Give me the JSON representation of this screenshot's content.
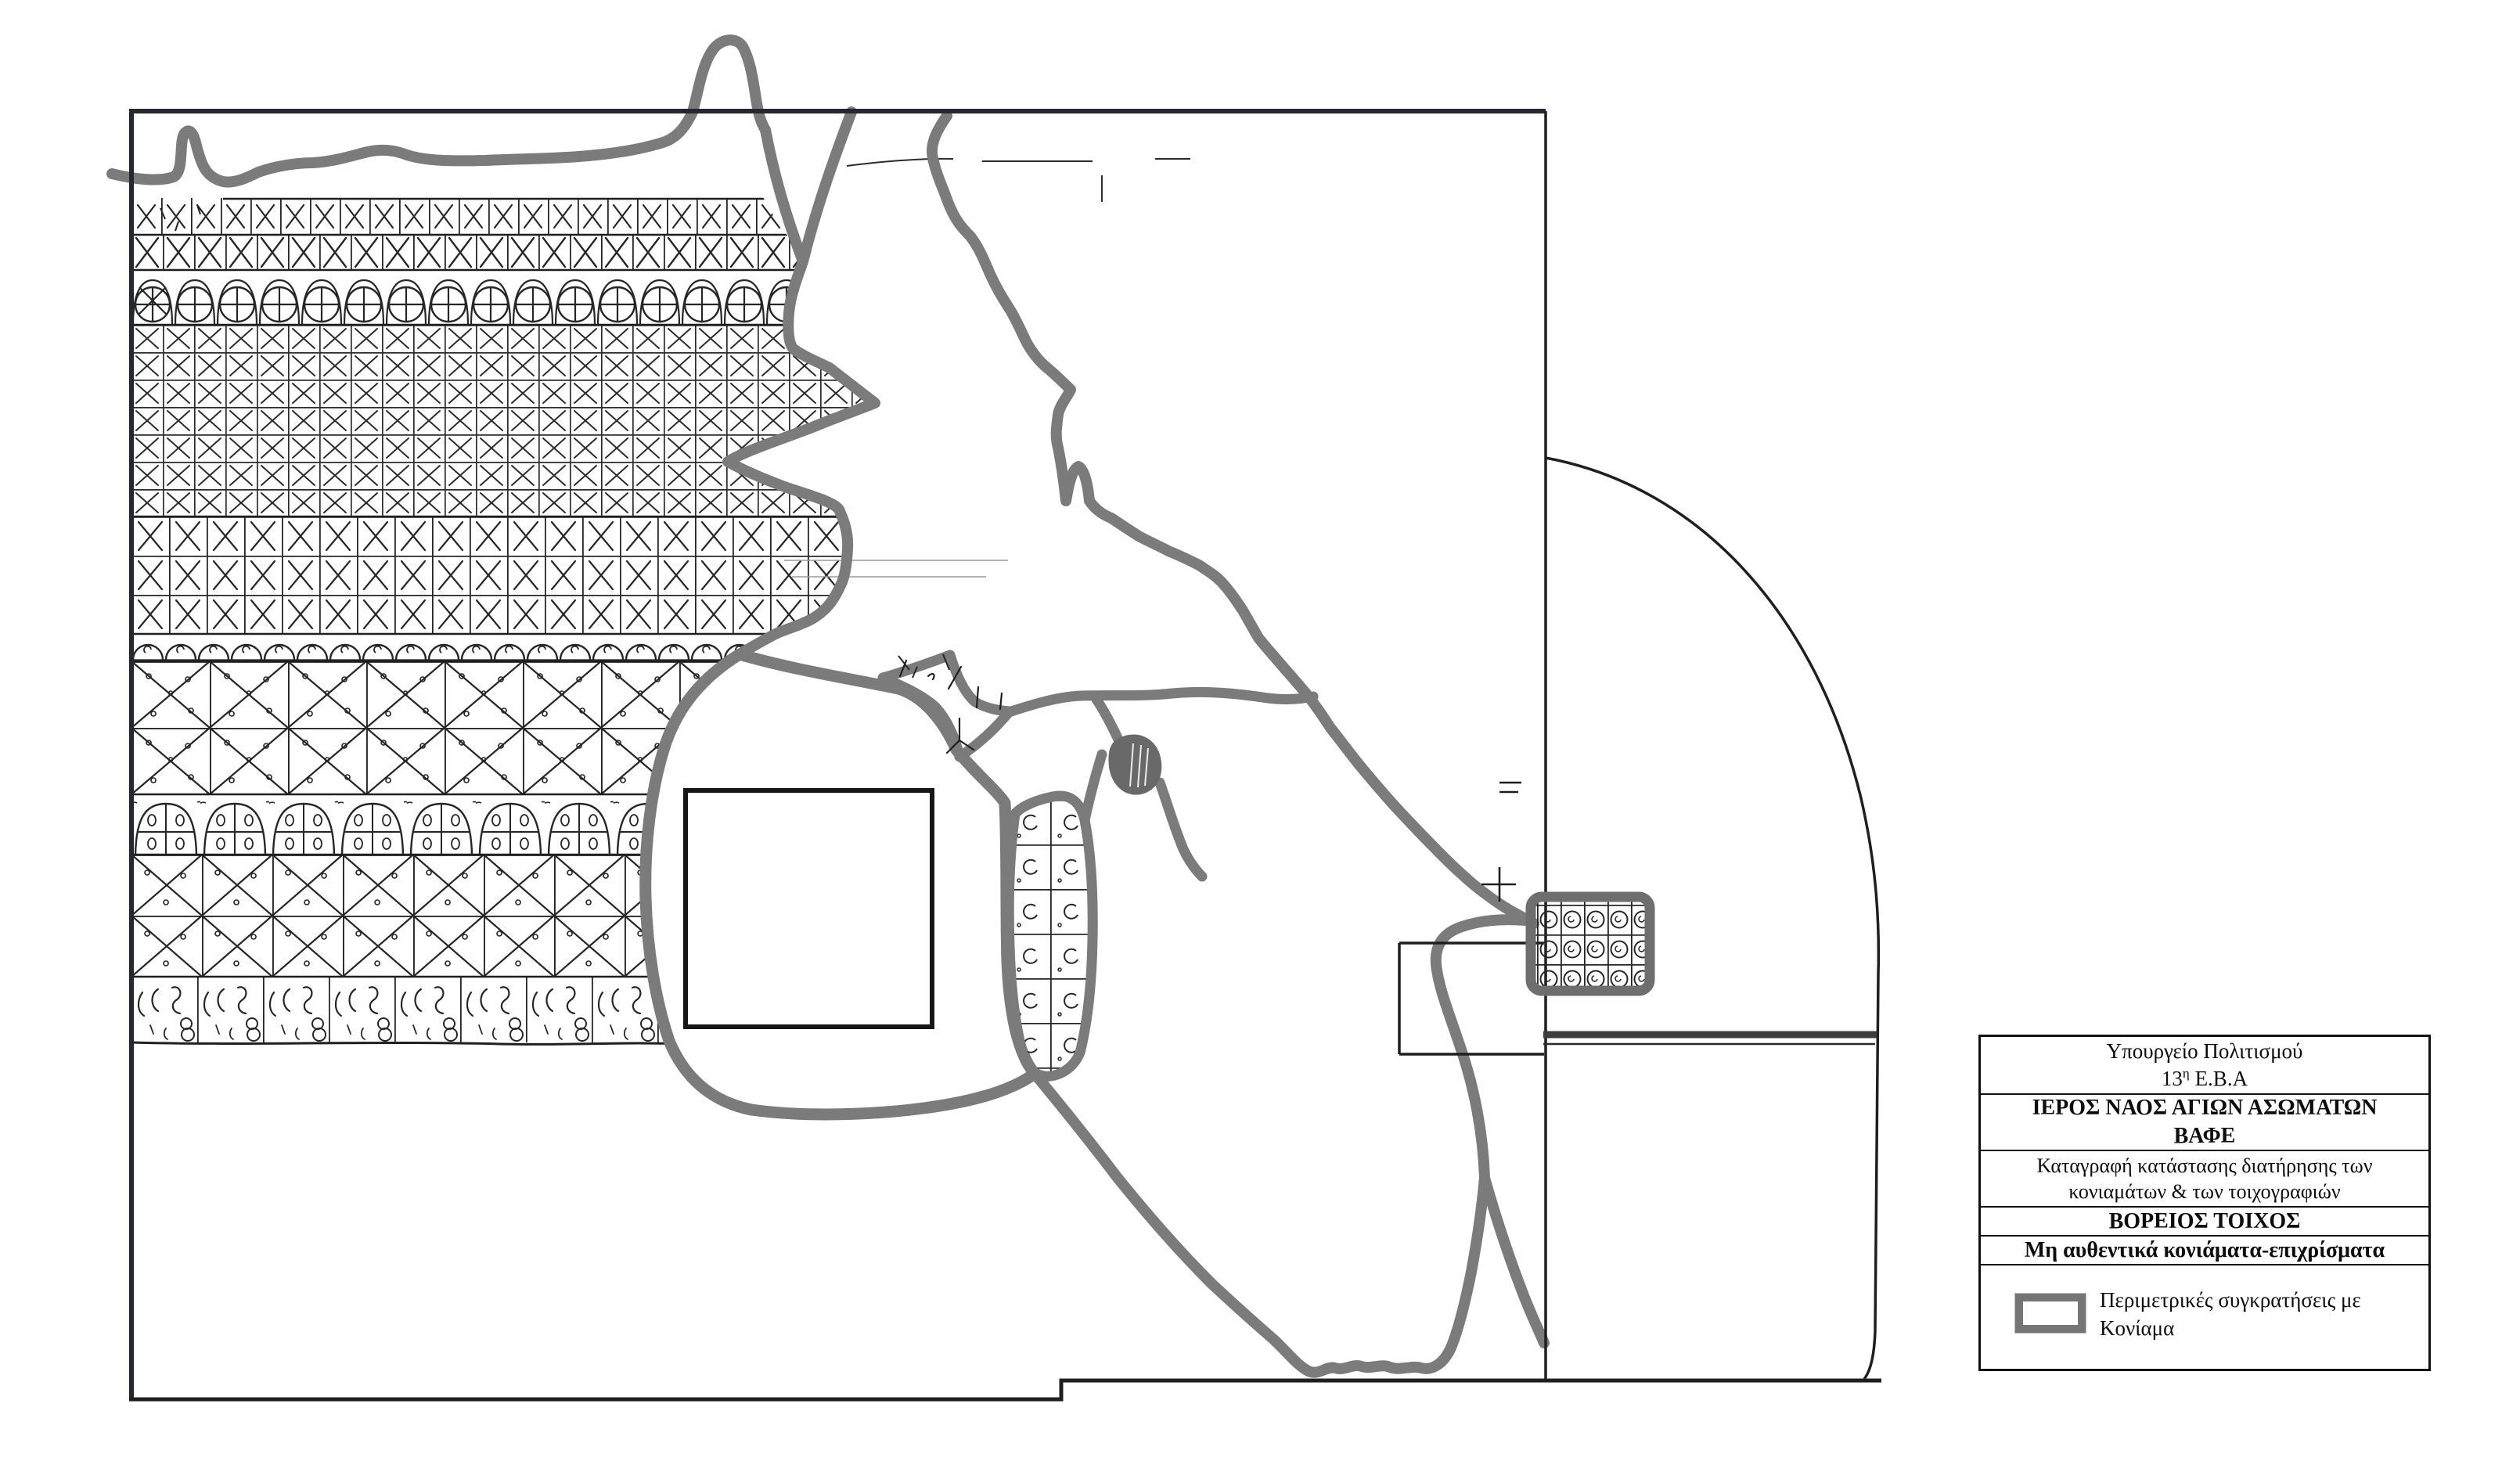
{
  "titleblock": {
    "agency_line1": "Υπουργείο Πολιτισμού",
    "agency_line2_prefix": "13",
    "agency_line2_sup": "η",
    "agency_line2_suffix": " Ε.Β.Α",
    "monument_line1": "ΙΕΡΟΣ ΝΑΟΣ ΑΓΙΩΝ ΑΣΩΜΑΤΩΝ",
    "monument_line2": "ΒΑΦΕ",
    "survey_line1": "Καταγραφή κατάστασης διατήρησης των",
    "survey_line2": "κονιαμάτων & των τοιχογραφιών",
    "wall_title": "ΒΟΡΕΙΟΣ ΤΟΙΧΟΣ",
    "layer_title": "Μη αυθεντικά κονιάματα-επιχρίσματα",
    "legend": {
      "swatch_name": "perimeter-mortar-retention-swatch",
      "label_line1": "Περιμετρικές συγκρατήσεις με",
      "label_line2": "Κονίαμα"
    }
  },
  "drawing": {
    "description_names": [
      "north-wall-elevation",
      "apse-quarter-section",
      "window-opening",
      "plaster-pattern-bands",
      "mortar-retention-outlines",
      "mortar-patch"
    ],
    "colors": {
      "paper": "#ffffff",
      "ink": "#1f1f1f",
      "border": "#242830",
      "retention_gray": "#7b7b7b",
      "patch_fill_gray": "#696969"
    }
  }
}
